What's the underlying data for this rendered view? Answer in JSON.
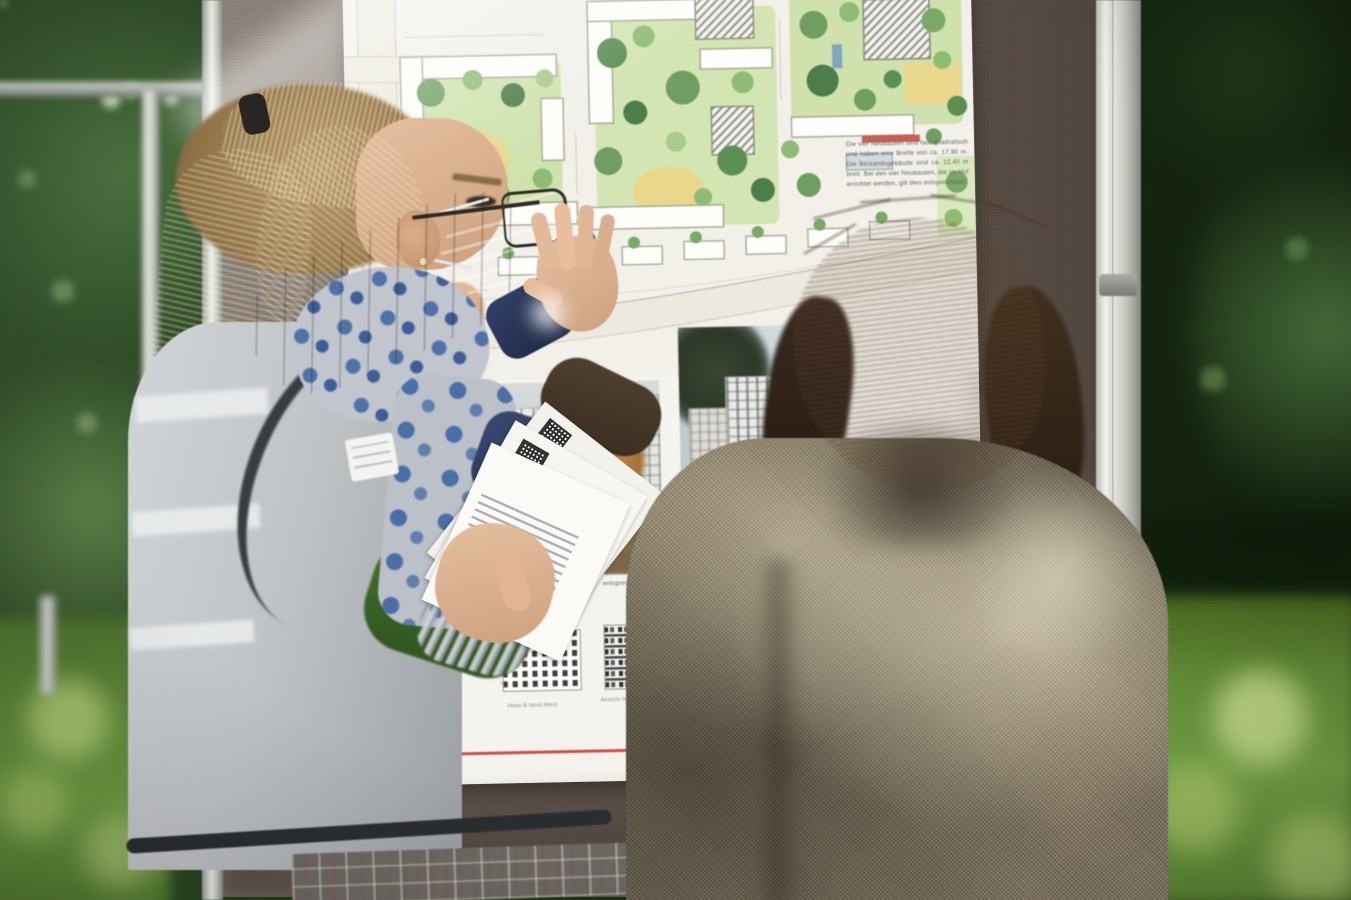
{
  "scene": {
    "type": "outdoor-photograph",
    "description": "A presenter in a grey safety vest, light-blue face mask and green puffer jacket explains an urban development site plan pinned to a fabric display board to a visitor in a beige tweed coat, outdoors on a lawn with trees.",
    "people": {
      "presenter": "blonde ponytail, glasses, light blue face mask, blue floral scarf, green puffer jacket, grey safety vest with name badge, holding flyers with QR codes, pointing at the plan",
      "visitor": "dark wavy hair, beige tweed coat, seen from behind"
    },
    "board": {
      "kind": "fabric pinboard with aluminium frame",
      "fabric_color": "#6b5f57",
      "frame_color": "#eef0ea"
    },
    "colors": {
      "foliage_dark": "#1b3016",
      "grass": "#5d8638",
      "poster_paper": "#f6f5f0",
      "plan_green": "#cfe2ad",
      "plan_tree": "#5d8f55",
      "plan_yellow": "#e9d78c",
      "accent_red": "#c8423a",
      "mask_blue": "#a5cad4",
      "jacket_green": "#46752c",
      "vest_grey": "#c1c4c7",
      "coat_tweed": "#8d8169"
    }
  },
  "poster": {
    "info_text": "Die vier Neubauten sind fast quadratisch und haben eine Breite von ca. 17,90 m. Die Bestandsgebäude sind ca. 12,40 m breit. Bei den vier Neubauten, die im Hof errichtet werden, gilt dies entsprechend.",
    "para_left": "werden in Massivbauweise errichtet. Sie werden eine Dämmung besitzen. Wärmeschutzverglasung und sind über eine Dreh-Kipp-Funktion zu öffnen. Die förderlichen Grenzwerte des sommerlichen Wärmeschutzes werden auf eine entsprechende Sonnenschutzverglasung",
    "para_right_1": "Im Erdgeschoss werden die Wohnungen gesichert und besichert.",
    "para_right_2": "Die Dächer werden begrünt und wird entsprechend ausgeführt.",
    "caption_photo_right": "Blick von Norden",
    "caption_elev_left": "Haus B Nord-West",
    "caption_elev_right": "Ansicht Haus B Süd-West"
  }
}
